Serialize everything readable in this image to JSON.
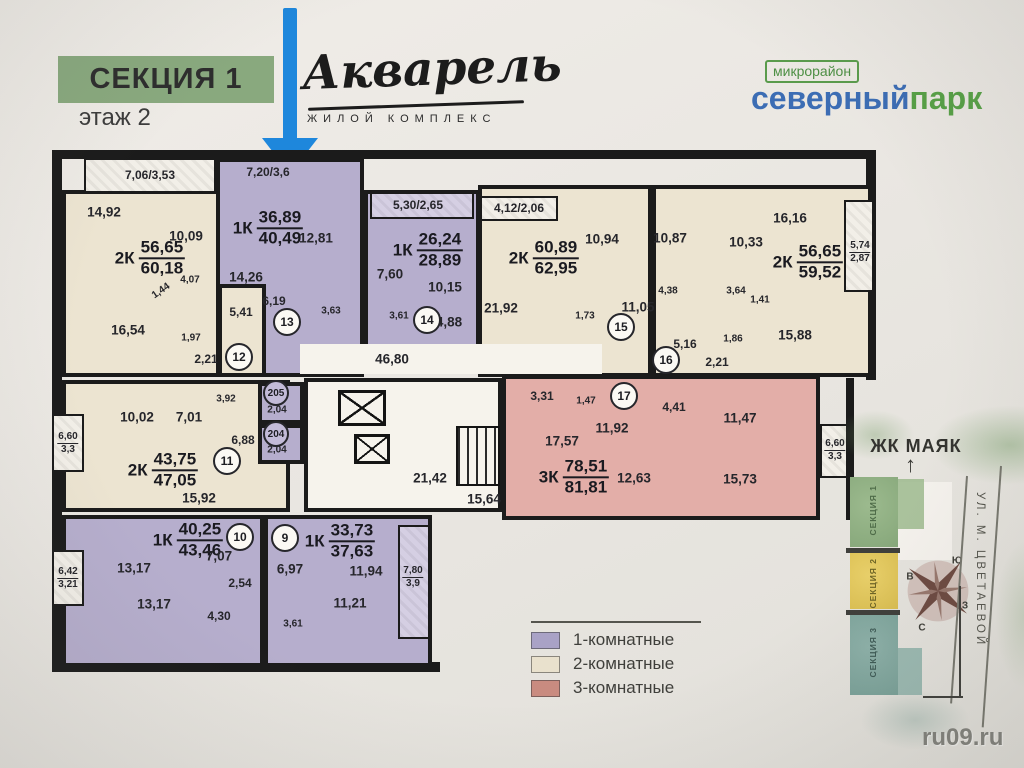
{
  "header": {
    "section_badge": "СЕКЦИЯ 1",
    "floor_label": "этаж 2",
    "logo_title": "Акварель",
    "logo_subtitle": "жилой комплекс",
    "district_tag": "микрорайон",
    "district_name_blue": "северный",
    "district_name_green": "парк"
  },
  "plan": {
    "a12": {
      "num": "12",
      "type": "2К",
      "living": "56,65",
      "total": "60,18",
      "balcony": "7,06/3,53",
      "r1": "14,92",
      "r2": "10,09",
      "r3": "16,54",
      "r4": "4,07",
      "r5": "1,44",
      "r6": "5,41",
      "r7": "1,97",
      "r8": "2,21"
    },
    "a13": {
      "num": "13",
      "type": "1К",
      "living": "36,89",
      "total": "40,49",
      "balcony": "7,20/3,6",
      "r1": "12,81",
      "r2": "14,26",
      "r3": "6,19",
      "r4": "3,63"
    },
    "a14": {
      "num": "14",
      "type": "1К",
      "living": "26,24",
      "total": "28,89",
      "balcony": "5,30/2,65",
      "r1": "7,60",
      "r2": "10,15",
      "r3": "3,61",
      "r4": "4,88"
    },
    "a15": {
      "num": "15",
      "type": "2К",
      "living": "60,89",
      "total": "62,95",
      "balcony": "4,12/2,06",
      "r1": "10,94",
      "r2": "21,92",
      "r3": "1,73",
      "r4": "11,05"
    },
    "a16": {
      "num": "16",
      "type": "2К",
      "living": "56,65",
      "total": "59,52",
      "bal_a": "5,74",
      "bal_b": "2,87",
      "r1": "10,87",
      "r2": "10,33",
      "r3": "16,16",
      "r4": "4,38",
      "r5": "3,64",
      "r6": "1,41",
      "r7": "5,16",
      "r8": "1,86",
      "r9": "2,21",
      "r10": "15,88"
    },
    "a11": {
      "num": "11",
      "type": "2К",
      "living": "43,75",
      "total": "47,05",
      "bal_a": "6,60",
      "bal_b": "3,3",
      "r1": "10,02",
      "r2": "7,01",
      "r3": "3,92",
      "r4": "6,88",
      "r5": "15,92"
    },
    "a17": {
      "num": "17",
      "type": "3К",
      "living": "78,51",
      "total": "81,81",
      "bal_a": "6,60",
      "bal_b": "3,3",
      "r1": "3,31",
      "r2": "1,47",
      "r3": "17,57",
      "r4": "11,92",
      "r5": "4,41",
      "r6": "11,47",
      "r7": "12,63",
      "r8": "15,73"
    },
    "a10": {
      "num": "10",
      "type": "1К",
      "living": "40,25",
      "total": "43,46",
      "bal_a": "6,42",
      "bal_b": "3,21",
      "r1": "13,17",
      "r2": "13,17",
      "r3": "7,07",
      "r4": "2,54",
      "r5": "4,30"
    },
    "a9": {
      "num": "9",
      "type": "1К",
      "living": "33,73",
      "total": "37,63",
      "bal_a": "7,80",
      "bal_b": "3,9",
      "r1": "6,97",
      "r2": "11,94",
      "r3": "11,21",
      "r4": "3,61"
    },
    "corridor_top": "46,80",
    "hall": "21,42",
    "stairs": "15,64",
    "s205": {
      "num": "205",
      "area": "2,04"
    },
    "s204": {
      "num": "204",
      "area": "2,04"
    }
  },
  "legend": {
    "items": [
      {
        "label": "1-комнатные",
        "color": "#a9a2c6"
      },
      {
        "label": "2-комнатные",
        "color": "#e9e1cd"
      },
      {
        "label": "3-комнатные",
        "color": "#c98b80"
      }
    ]
  },
  "minimap": {
    "title": "ЖК МАЯК",
    "sections": [
      {
        "label": "СЕКЦИЯ 1",
        "color": "#93b286"
      },
      {
        "label": "СЕКЦИЯ 2",
        "color": "#e2c75e"
      },
      {
        "label": "СЕКЦИЯ 3",
        "color": "#84aaa2"
      }
    ],
    "street": "УЛ. М. ЦВЕТАЕВОЙ",
    "compass": {
      "n": "С",
      "s": "Ю",
      "w": "З",
      "e": "В"
    }
  },
  "watermark": "ru09.ru",
  "colors": {
    "one_room": "#b6aecd",
    "two_room": "#ece4d1",
    "three_room": "#e3aea8",
    "badge_green": "#89a97e",
    "arrow_blue": "#1e87dc",
    "brand_blue": "#3c6db4",
    "brand_green": "#57a046"
  }
}
